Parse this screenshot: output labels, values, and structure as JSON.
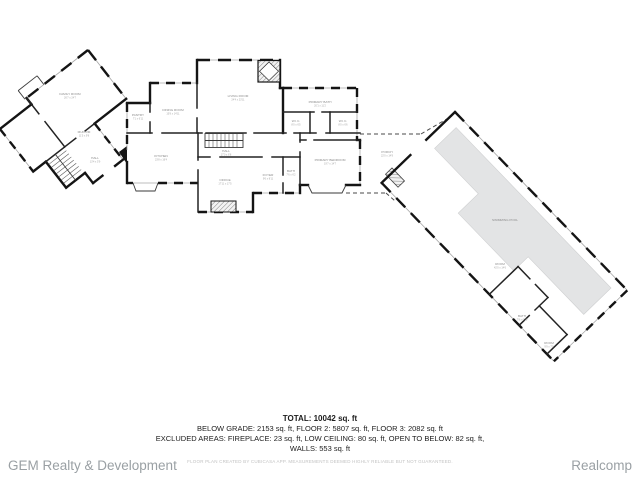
{
  "summary": {
    "total": "TOTAL: 10042 sq. ft",
    "line2": "BELOW GRADE: 2153 sq. ft, FLOOR 2: 5807 sq. ft, FLOOR 3: 2082 sq. ft",
    "line3": "EXCLUDED AREAS: FIREPLACE: 23 sq. ft, LOW CEILING: 80 sq. ft, OPEN TO BELOW: 82 sq. ft,",
    "line4": "WALLS: 553 sq. ft"
  },
  "footer": {
    "brand_left": "GEM Realty & Development",
    "brand_right": "Realcomp",
    "disclaimer": "FLOOR PLAN CREATED BY CUBICASA APP. MEASUREMENTS DEEMED HIGHLY RELIABLE BUT NOT GUARANTEED."
  },
  "floorplan": {
    "colors": {
      "wall": "#141414",
      "window": "#a6a6a6",
      "pool_fill": "#e3e4e5",
      "label": "#8a8a8a"
    },
    "rooms": [
      {
        "label": "FAMILY ROOM",
        "dims": "26'7 x 24'7"
      },
      {
        "label": "MUD RM",
        "dims": "11'5 x 9'8"
      },
      {
        "label": "HALL",
        "dims": "13'4 x 5'9"
      },
      {
        "label": "PANTRY",
        "dims": "7'1 x 6'11"
      },
      {
        "label": "DINING ROOM",
        "dims": "15'8 x 14'11"
      },
      {
        "label": "LIVING ROOM",
        "dims": "24'4 x 23'11"
      },
      {
        "label": "KITCHEN",
        "dims": "23'8 x 16'4"
      },
      {
        "label": "HALL",
        "dims": "17'0 x 6'8"
      },
      {
        "label": "OFFICE",
        "dims": "17'11 x 17'5"
      },
      {
        "label": "PRIMARY BATH",
        "dims": "20'1 x 11'2"
      },
      {
        "label": "W.I.C.",
        "dims": "8'0 x 6'5"
      },
      {
        "label": "W.I.C.",
        "dims": "8'0 x 6'6"
      },
      {
        "label": "PRIMARY BEDROOM",
        "dims": "19'7 x 14'7"
      },
      {
        "label": "FOYER",
        "dims": "9'6 x 8'11"
      },
      {
        "label": "BATH",
        "dims": "7'6 x 6'2"
      },
      {
        "label": "PORCH",
        "dims": "22'0 x 14'9"
      },
      {
        "label": "SWIMMING POOL",
        "dims": ""
      },
      {
        "label": "ROOM",
        "dims": "42'0 x 14'6"
      },
      {
        "label": "BATH",
        "dims": "7'8 x 6'10"
      },
      {
        "label": "ROOM",
        "dims": "9'9 x 7'0"
      }
    ]
  }
}
